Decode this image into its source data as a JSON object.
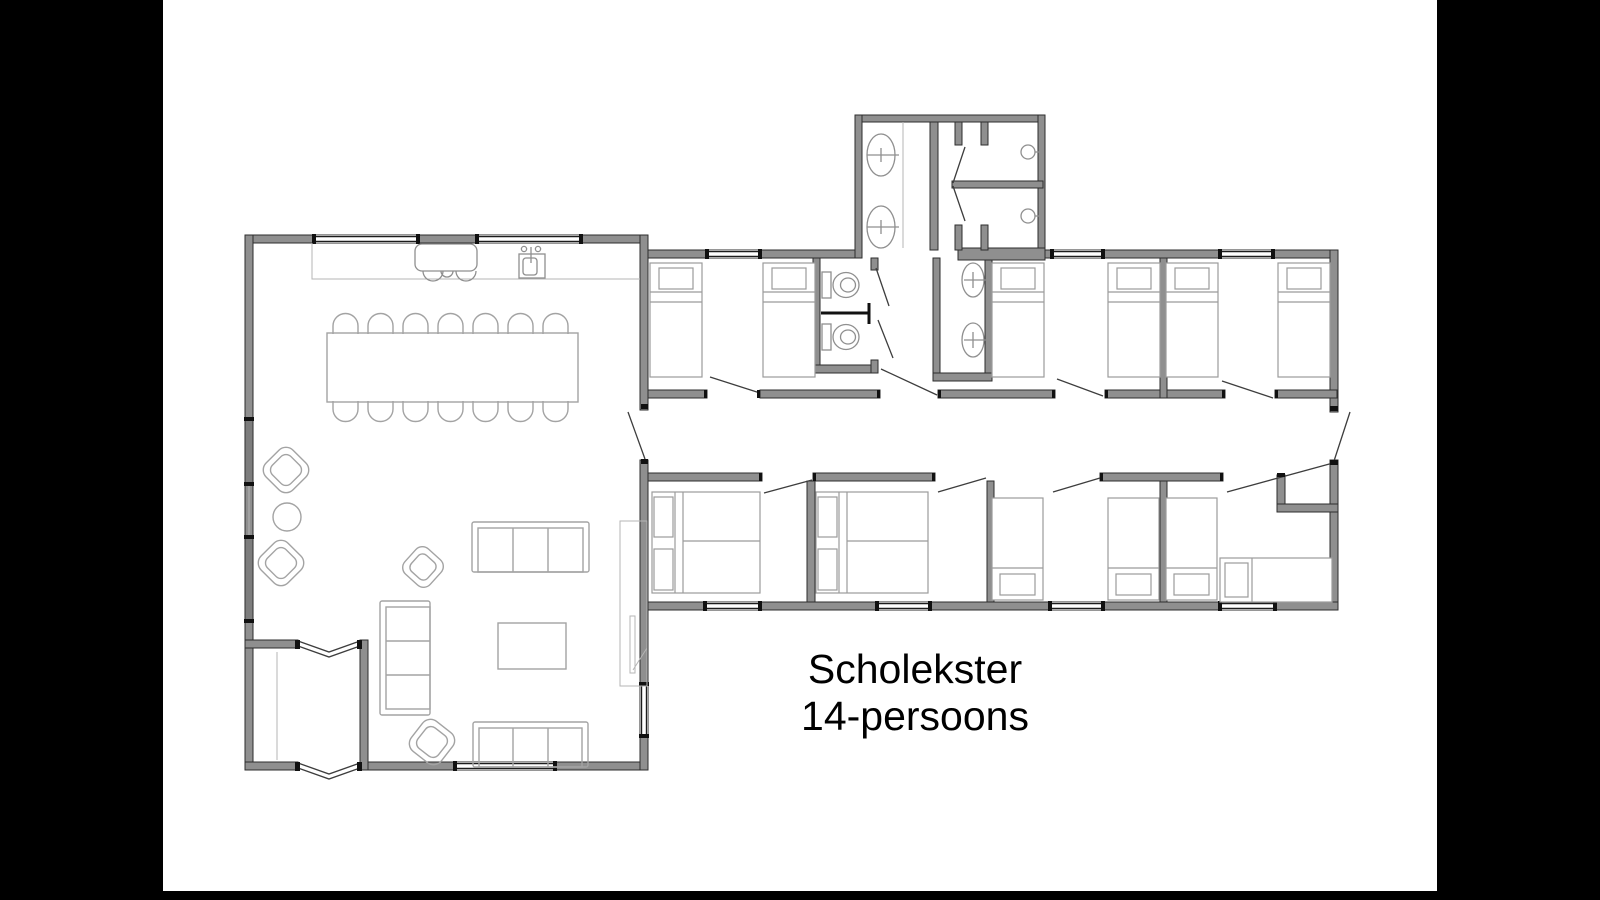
{
  "title": {
    "line1": "Scholekster",
    "line2": "14-persoons"
  },
  "colors": {
    "background": "#ffffff",
    "letterbox": "#000000",
    "wall_fill": "#8f8f8f",
    "wall_edge": "#2e2e2e",
    "furniture_line": "#a3a3a3",
    "fixture_line": "#8f8f8f",
    "door_line": "#3d3d3d",
    "text": "#000000"
  },
  "floorplan": {
    "fixtures": {
      "dining_chairs": 14,
      "dining_tables": 1,
      "single_beds": 10,
      "double_beds": 2,
      "sofas": 3,
      "armchairs": 4,
      "coffee_tables": 1,
      "side_tables": 1,
      "toilets": 2,
      "washbasins": 4,
      "showers": 2,
      "kitchen_sinks": 1,
      "cooktops": 1
    }
  }
}
